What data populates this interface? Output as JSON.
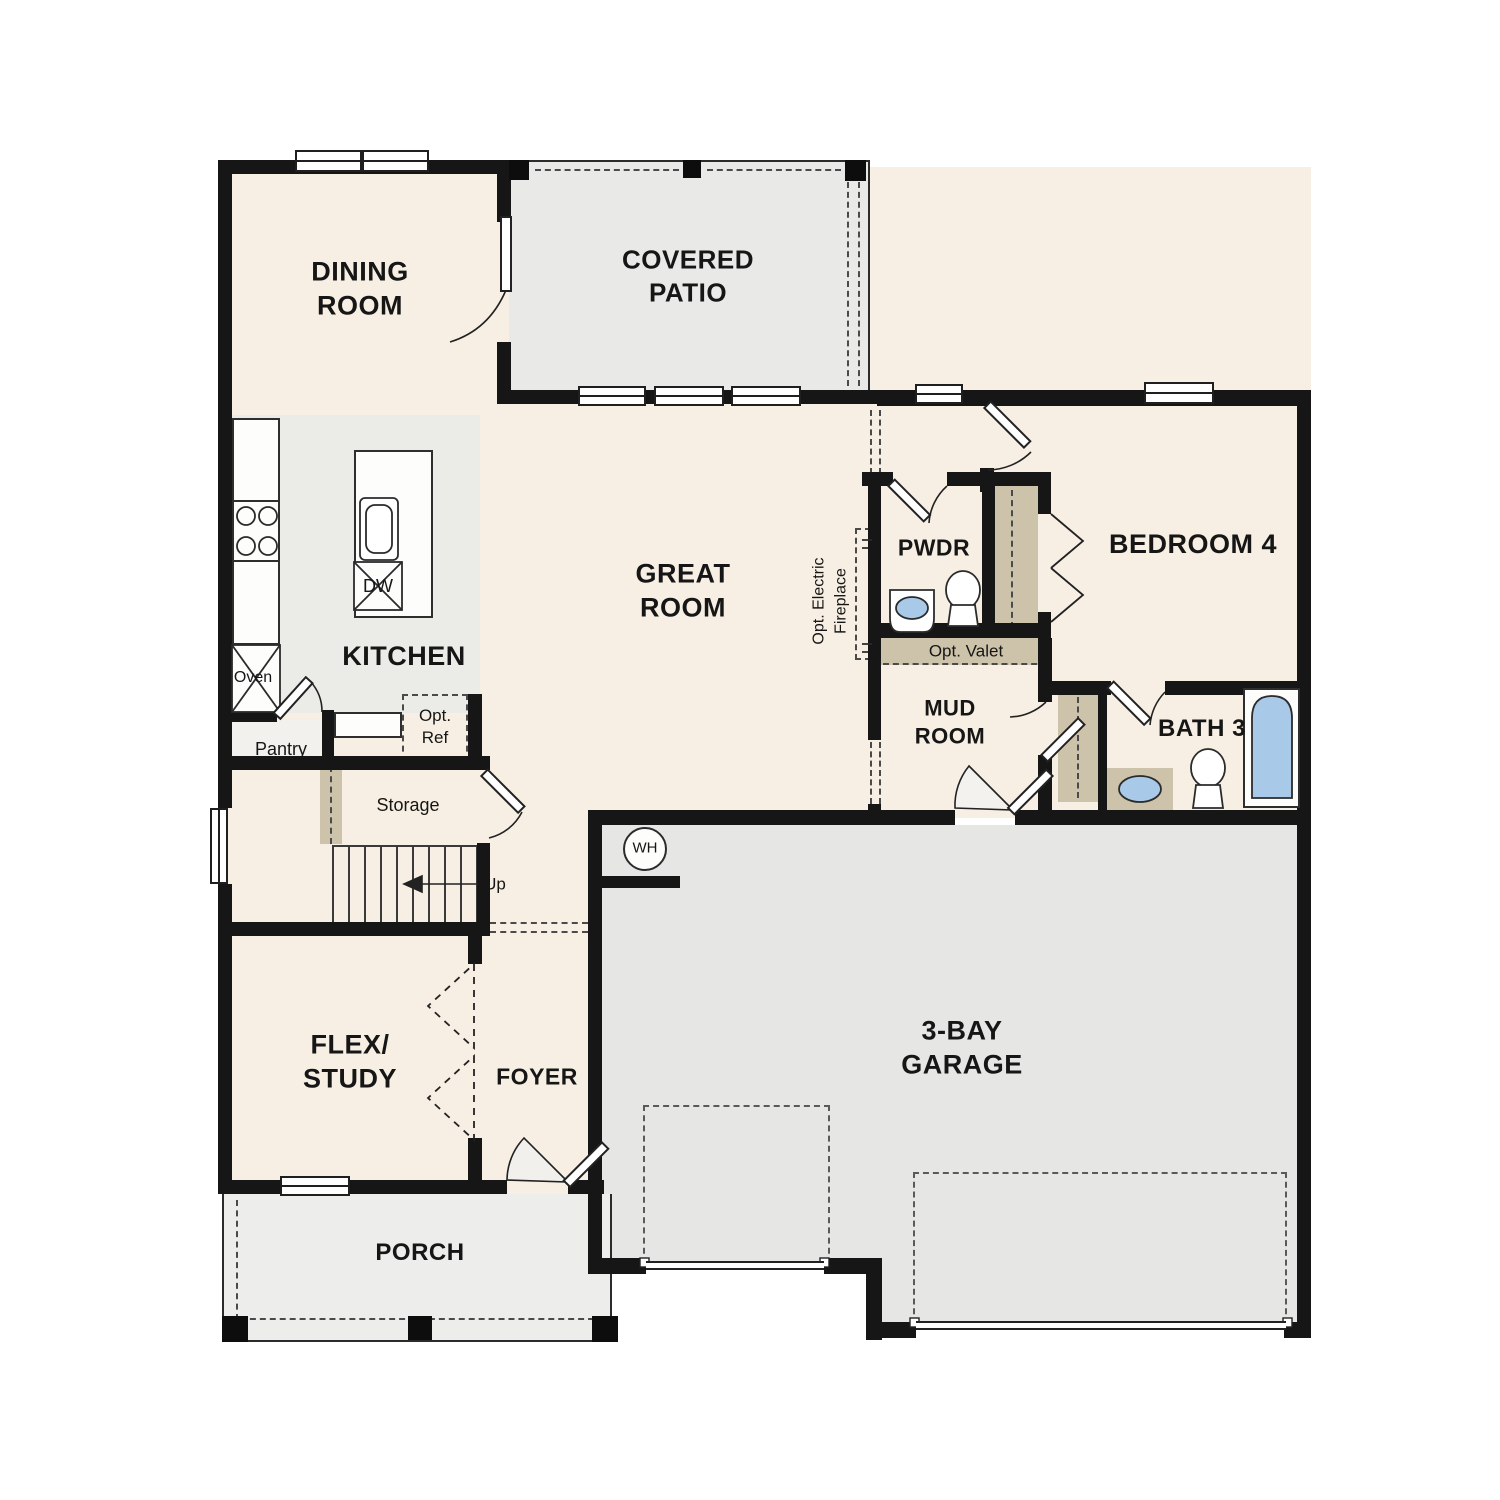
{
  "title": "First floor plan",
  "colors": {
    "cream": "#f7efe3",
    "patioGray": "#e9e9e8",
    "garageGray": "#e6e6e4",
    "kitchenGray": "#ebebe8",
    "porchGray": "#ededec",
    "tan": "#cdc2aa",
    "fixtureBlue": "#a9c9e9",
    "wall": "#161616"
  },
  "rooms": {
    "dining": "DINING ROOM",
    "patio": "COVERED PATIO",
    "kitchen": "KITCHEN",
    "great": "GREAT ROOM",
    "pwdr": "PWDR",
    "bedroom4": "BEDROOM 4",
    "mud": "MUD ROOM",
    "bath3": "BATH 3",
    "flex": "FLEX/ STUDY",
    "foyer": "FOYER",
    "porch": "PORCH",
    "garage": "3-BAY GARAGE"
  },
  "features": {
    "oven": "Oven",
    "dw": "DW",
    "pantry": "Pantry",
    "opt_ref": "Opt. Ref",
    "storage": "Storage",
    "up": "Up",
    "wh": "WH",
    "opt_valet": "Opt. Valet",
    "opt_fireplace": "Opt. Electric Fireplace"
  }
}
